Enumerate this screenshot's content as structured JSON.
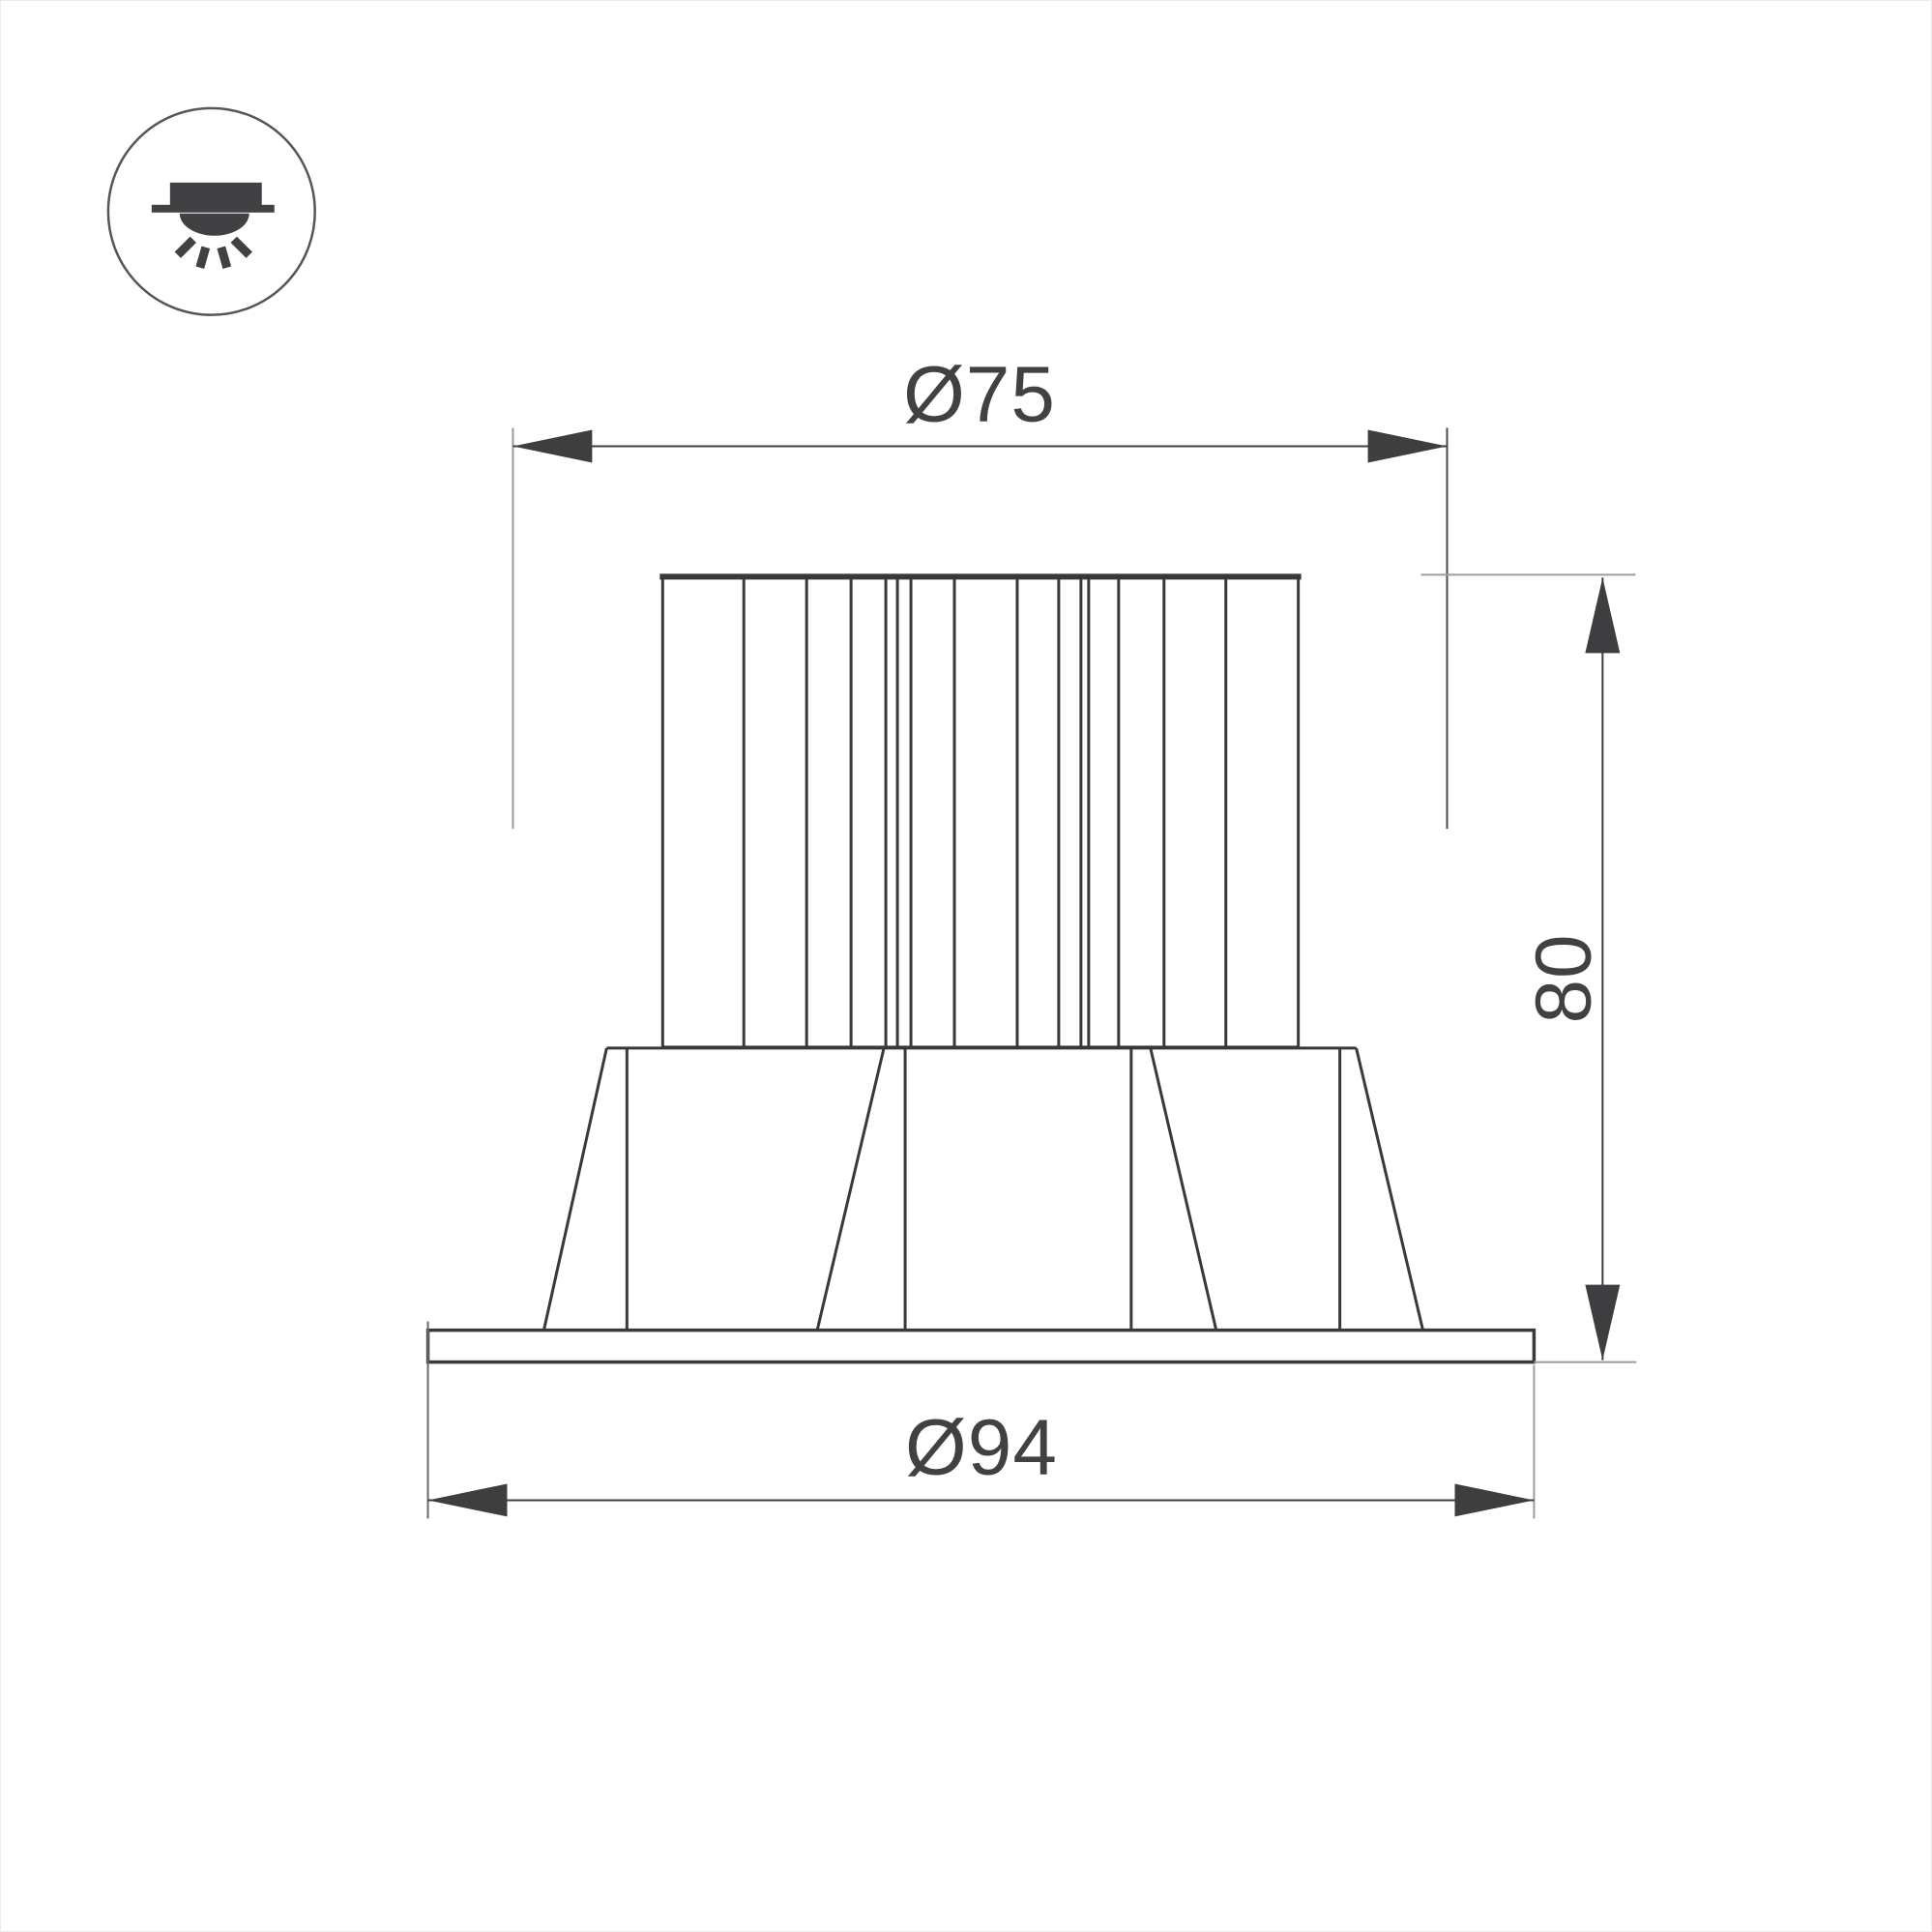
{
  "drawing": {
    "type": "technical-dimension-drawing",
    "subject": "recessed downlight fixture with finned heatsink, tapered body and trim flange",
    "views": [
      "front elevation"
    ],
    "icon": {
      "name": "recessed-downlight-icon",
      "meaning": "recessed ceiling-mounted luminaire shining downward"
    },
    "dimensions": {
      "top_diameter": {
        "label": "Ø75",
        "value": 75
      },
      "height": {
        "label": "80",
        "value": 80
      },
      "bottom_diameter": {
        "label": "Ø94",
        "value": 94
      }
    },
    "colors": {
      "background": "#ffffff",
      "outline": "#39393b",
      "dimension": "#3e3e40",
      "extension_gray": "#9c9c9c",
      "text": "#414143"
    }
  }
}
